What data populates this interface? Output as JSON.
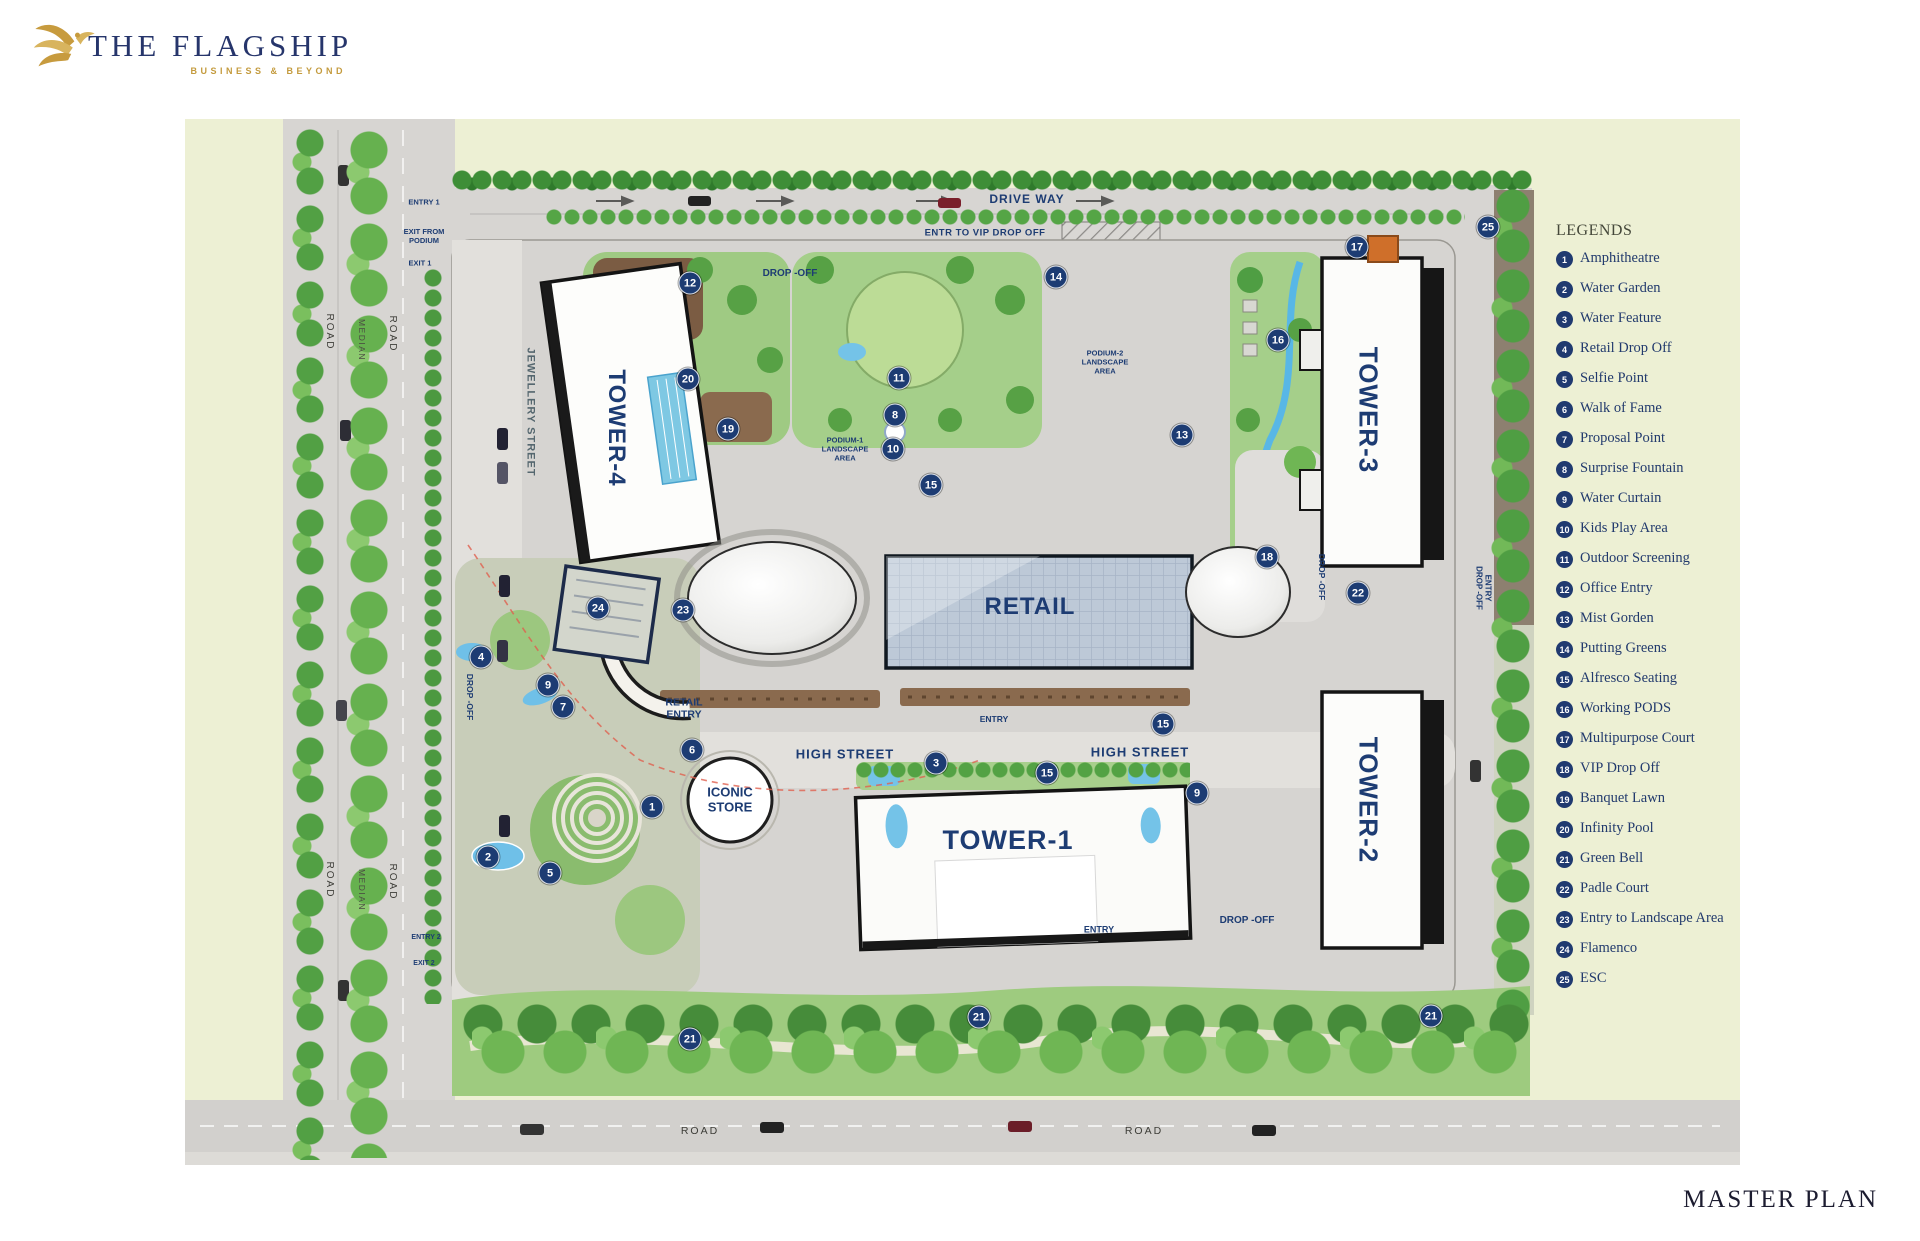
{
  "colors": {
    "navy": "#1d3c73",
    "gold": "#c49b3e",
    "field_green": "#edf0d4",
    "road_gray": "#d7d5d2",
    "water_blue": "#74c3e8",
    "legend_text": "#223a6d"
  },
  "logo": {
    "title": "THE FLAGSHIP",
    "tagline": "BUSINESS & BEYOND"
  },
  "footer": {
    "title": "MASTER PLAN"
  },
  "legend": {
    "title": "LEGENDS",
    "items": [
      {
        "num": "1",
        "label": "Amphitheatre"
      },
      {
        "num": "2",
        "label": "Water Garden"
      },
      {
        "num": "3",
        "label": "Water Feature"
      },
      {
        "num": "4",
        "label": "Retail Drop Off"
      },
      {
        "num": "5",
        "label": "Selfie Point"
      },
      {
        "num": "6",
        "label": "Walk of Fame"
      },
      {
        "num": "7",
        "label": "Proposal Point"
      },
      {
        "num": "8",
        "label": "Surprise Fountain"
      },
      {
        "num": "9",
        "label": "Water Curtain"
      },
      {
        "num": "10",
        "label": "Kids Play Area"
      },
      {
        "num": "11",
        "label": "Outdoor Screening"
      },
      {
        "num": "12",
        "label": "Office Entry"
      },
      {
        "num": "13",
        "label": "Mist Gorden"
      },
      {
        "num": "14",
        "label": "Putting Greens"
      },
      {
        "num": "15",
        "label": "Alfresco Seating"
      },
      {
        "num": "16",
        "label": "Working PODS"
      },
      {
        "num": "17",
        "label": "Multipurpose Court"
      },
      {
        "num": "18",
        "label": "VIP Drop Off"
      },
      {
        "num": "19",
        "label": "Banquet Lawn"
      },
      {
        "num": "20",
        "label": "Infinity Pool"
      },
      {
        "num": "21",
        "label": "Green Bell"
      },
      {
        "num": "22",
        "label": "Padle Court"
      },
      {
        "num": "23",
        "label": "Entry to Landscape Area"
      },
      {
        "num": "24",
        "label": "Flamenco"
      },
      {
        "num": "25",
        "label": "ESC"
      }
    ]
  },
  "plan": {
    "markers": [
      {
        "num": "12",
        "x": 690,
        "y": 283
      },
      {
        "num": "14",
        "x": 1056,
        "y": 277
      },
      {
        "num": "17",
        "x": 1357,
        "y": 247
      },
      {
        "num": "25",
        "x": 1488,
        "y": 227
      },
      {
        "num": "20",
        "x": 688,
        "y": 379
      },
      {
        "num": "11",
        "x": 899,
        "y": 378
      },
      {
        "num": "8",
        "x": 895,
        "y": 415
      },
      {
        "num": "10",
        "x": 893,
        "y": 449
      },
      {
        "num": "19",
        "x": 728,
        "y": 429
      },
      {
        "num": "16",
        "x": 1278,
        "y": 340
      },
      {
        "num": "13",
        "x": 1182,
        "y": 435
      },
      {
        "num": "15",
        "x": 931,
        "y": 485
      },
      {
        "num": "18",
        "x": 1267,
        "y": 557
      },
      {
        "num": "22",
        "x": 1358,
        "y": 593
      },
      {
        "num": "23",
        "x": 683,
        "y": 610
      },
      {
        "num": "24",
        "x": 598,
        "y": 608
      },
      {
        "num": "4",
        "x": 481,
        "y": 657
      },
      {
        "num": "9",
        "x": 548,
        "y": 685
      },
      {
        "num": "7",
        "x": 563,
        "y": 707
      },
      {
        "num": "6",
        "x": 692,
        "y": 750
      },
      {
        "num": "3",
        "x": 936,
        "y": 763
      },
      {
        "num": "15",
        "x": 1047,
        "y": 773
      },
      {
        "num": "15",
        "x": 1163,
        "y": 724
      },
      {
        "num": "9",
        "x": 1197,
        "y": 793
      },
      {
        "num": "1",
        "x": 652,
        "y": 807
      },
      {
        "num": "2",
        "x": 488,
        "y": 857
      },
      {
        "num": "5",
        "x": 550,
        "y": 873
      },
      {
        "num": "21",
        "x": 690,
        "y": 1039
      },
      {
        "num": "21",
        "x": 979,
        "y": 1017
      },
      {
        "num": "21",
        "x": 1431,
        "y": 1016
      }
    ],
    "labels": [
      {
        "id": "drive-way",
        "text": "DRIVE WAY",
        "x": 1027,
        "y": 199,
        "size": 12,
        "ls": 1
      },
      {
        "id": "vip-drop-off-entry",
        "text": "ENTR TO VIP DROP OFF",
        "x": 985,
        "y": 233,
        "size": 9.5,
        "ls": 0.5
      },
      {
        "id": "entry-1",
        "text": "ENTRY 1",
        "x": 424,
        "y": 203,
        "size": 7.5,
        "w": 600
      },
      {
        "id": "exit-from-podium",
        "text": "EXIT FROM\nPODIUM",
        "x": 424,
        "y": 237,
        "size": 7.5,
        "w": 600
      },
      {
        "id": "exit-1",
        "text": "EXIT 1",
        "x": 420,
        "y": 264,
        "size": 7.5,
        "w": 600
      },
      {
        "id": "road-w-upper-left",
        "text": "ROAD",
        "x": 329,
        "y": 332,
        "size": 10,
        "rot": 90,
        "color": "#3d3d38",
        "ls": 2,
        "w": 500
      },
      {
        "id": "median-upper",
        "text": "MEDIAN",
        "x": 362,
        "y": 340,
        "size": 8.5,
        "rot": 90,
        "color": "#4a4a42",
        "ls": 1.5,
        "w": 500
      },
      {
        "id": "road-e-upper-left",
        "text": "ROAD",
        "x": 392,
        "y": 334,
        "size": 10,
        "rot": 90,
        "color": "#3d3d38",
        "ls": 2,
        "w": 500
      },
      {
        "id": "road-w-lower-left",
        "text": "ROAD",
        "x": 329,
        "y": 880,
        "size": 10,
        "rot": 90,
        "color": "#3d3d38",
        "ls": 2,
        "w": 500
      },
      {
        "id": "median-lower",
        "text": "MEDIAN",
        "x": 362,
        "y": 890,
        "size": 8.5,
        "rot": 90,
        "color": "#4a4a42",
        "ls": 1.5,
        "w": 500
      },
      {
        "id": "road-e-lower-left",
        "text": "ROAD",
        "x": 392,
        "y": 882,
        "size": 10,
        "rot": 90,
        "color": "#3d3d38",
        "ls": 2,
        "w": 500
      },
      {
        "id": "jewellery-street",
        "text": "JEWELLERY STREET",
        "x": 530,
        "y": 412,
        "size": 11,
        "rot": 90,
        "color": "#55676f",
        "ls": 1
      },
      {
        "id": "drop-off-office",
        "text": "DROP -OFF",
        "x": 790,
        "y": 274,
        "size": 10
      },
      {
        "id": "podium-2-landscape",
        "text": "PODIUM-2\nLANDSCAPE\nAREA",
        "x": 1105,
        "y": 363,
        "size": 7.5
      },
      {
        "id": "podium-1-landscape",
        "text": "PODIUM-1\nLANDSCAPE\nAREA",
        "x": 845,
        "y": 450,
        "size": 7.5
      },
      {
        "id": "retail",
        "text": "RETAIL",
        "x": 1030,
        "y": 607,
        "size": 24,
        "ls": 1
      },
      {
        "id": "tower-4",
        "text": "TOWER-4",
        "x": 616,
        "y": 428,
        "size": 24,
        "rot": 90,
        "ls": 1
      },
      {
        "id": "tower-3",
        "text": "TOWER-3",
        "x": 1368,
        "y": 410,
        "size": 26,
        "rot": 90,
        "ls": 1
      },
      {
        "id": "tower-2",
        "text": "TOWER-2",
        "x": 1368,
        "y": 800,
        "size": 26,
        "rot": 90,
        "ls": 1
      },
      {
        "id": "tower-1",
        "text": "TOWER-1",
        "x": 1008,
        "y": 841,
        "size": 27,
        "ls": 1
      },
      {
        "id": "iconic-store",
        "text": "ICONIC\nSTORE",
        "x": 730,
        "y": 800,
        "size": 13
      },
      {
        "id": "retail-entry",
        "text": "RETAIL\nENTRY",
        "x": 684,
        "y": 709,
        "size": 10.5
      },
      {
        "id": "high-street-west",
        "text": "HIGH STREET",
        "x": 845,
        "y": 754,
        "size": 13,
        "ls": 1
      },
      {
        "id": "high-street-east",
        "text": "HIGH STREET",
        "x": 1140,
        "y": 752,
        "size": 13,
        "ls": 1
      },
      {
        "id": "entry-retail-south",
        "text": "ENTRY",
        "x": 994,
        "y": 719,
        "size": 8.5
      },
      {
        "id": "entry-tower-1",
        "text": "ENTRY",
        "x": 1099,
        "y": 930,
        "size": 9
      },
      {
        "id": "drop-off-tower-1",
        "text": "DROP -OFF",
        "x": 1247,
        "y": 921,
        "size": 10
      },
      {
        "id": "drop-off-west",
        "text": "DROP -OFF",
        "x": 470,
        "y": 697,
        "size": 8.5,
        "rot": 90
      },
      {
        "id": "drop-off-vip",
        "text": "DROP -OFF",
        "x": 1322,
        "y": 577,
        "size": 8.5,
        "rot": 90
      },
      {
        "id": "entry-drop-off-east",
        "text": "ENTRY\nDROP -OFF",
        "x": 1483,
        "y": 588,
        "size": 8,
        "rot": 90
      },
      {
        "id": "entry-2",
        "text": "ENTRY 2",
        "x": 426,
        "y": 938,
        "size": 7,
        "w": 600
      },
      {
        "id": "exit-2",
        "text": "EXIT 2",
        "x": 424,
        "y": 964,
        "size": 7,
        "w": 600
      },
      {
        "id": "road-south-west",
        "text": "ROAD",
        "x": 700,
        "y": 1131,
        "size": 10.5,
        "color": "#3d3d38",
        "ls": 2,
        "w": 500
      },
      {
        "id": "road-south-east",
        "text": "ROAD",
        "x": 1144,
        "y": 1131,
        "size": 10.5,
        "color": "#3d3d38",
        "ls": 2,
        "w": 500
      }
    ]
  }
}
